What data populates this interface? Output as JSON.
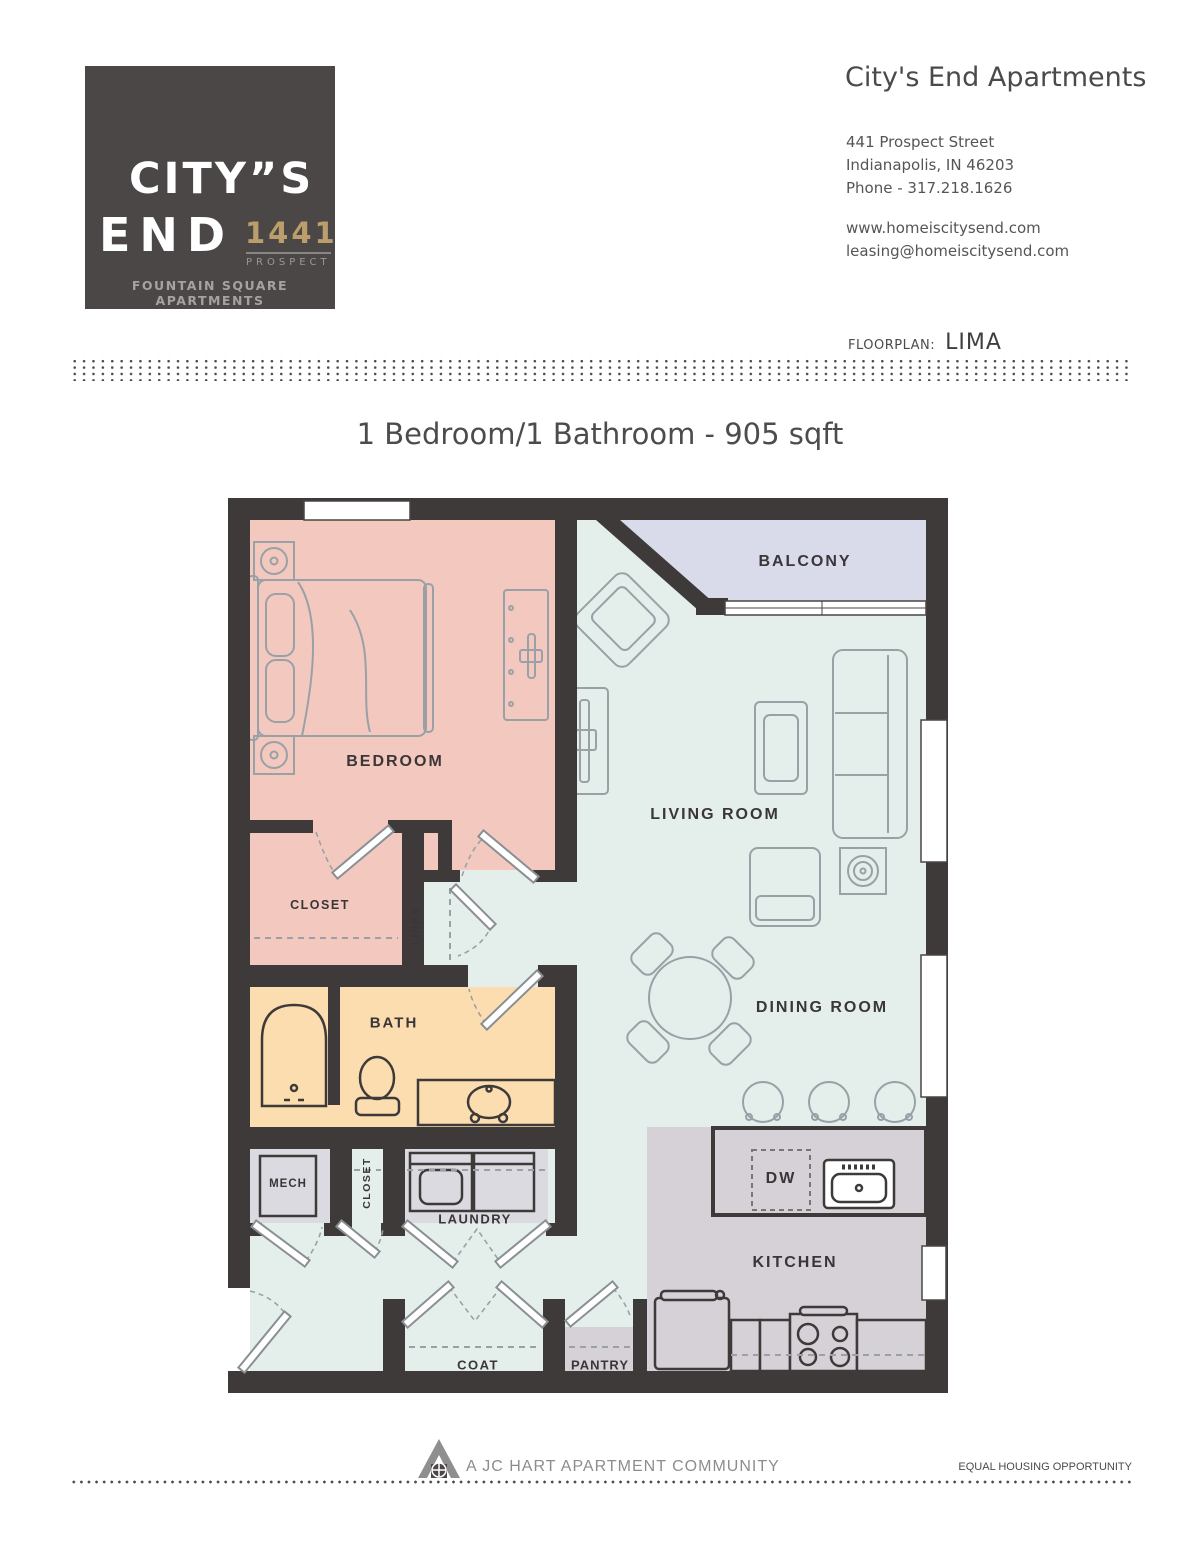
{
  "logo": {
    "brand_line1": "CITY”S",
    "brand_line2": "END",
    "brand_number": "1441",
    "brand_street": "PROSPECT",
    "tagline": "FOUNTAIN SQUARE APARTMENTS"
  },
  "header": {
    "title": "City's End Apartments",
    "address_line1": "441 Prospect Street",
    "address_line2": "Indianapolis, IN 46203",
    "phone": "Phone - 317.218.1626",
    "website": "www.homeiscitysend.com",
    "email": "leasing@homeiscitysend.com"
  },
  "floorplan": {
    "label": "FLOORPLAN:",
    "name": "LIMA"
  },
  "headline": "1 Bedroom/1 Bathroom - 905 sqft",
  "plan": {
    "labels": {
      "balcony": "BALCONY",
      "bedroom": "BEDROOM",
      "living_room": "LIVING ROOM",
      "dining_room": "DINING ROOM",
      "closet": "CLOSET",
      "linen": "LINEN",
      "bath": "BATH",
      "mech": "MECH",
      "hall_closet": "CLOSET",
      "laundry": "LAUNDRY",
      "coat": "COAT",
      "pantry": "PANTRY",
      "kitchen": "KITCHEN",
      "dishwasher": "DW"
    },
    "colors": {
      "wall": "#3e3a3a",
      "bedroom": "#f3c8bf",
      "living": "#e4efec",
      "balcony": "#d9daea",
      "bath": "#fbddb0",
      "kitchen": "#d6d0d7",
      "utility": "#dadae0",
      "furniture_line": "#99a1a6"
    }
  },
  "footer": {
    "community": "A JC HART APARTMENT COMMUNITY",
    "equal_housing": "EQUAL HOUSING OPPORTUNITY"
  }
}
